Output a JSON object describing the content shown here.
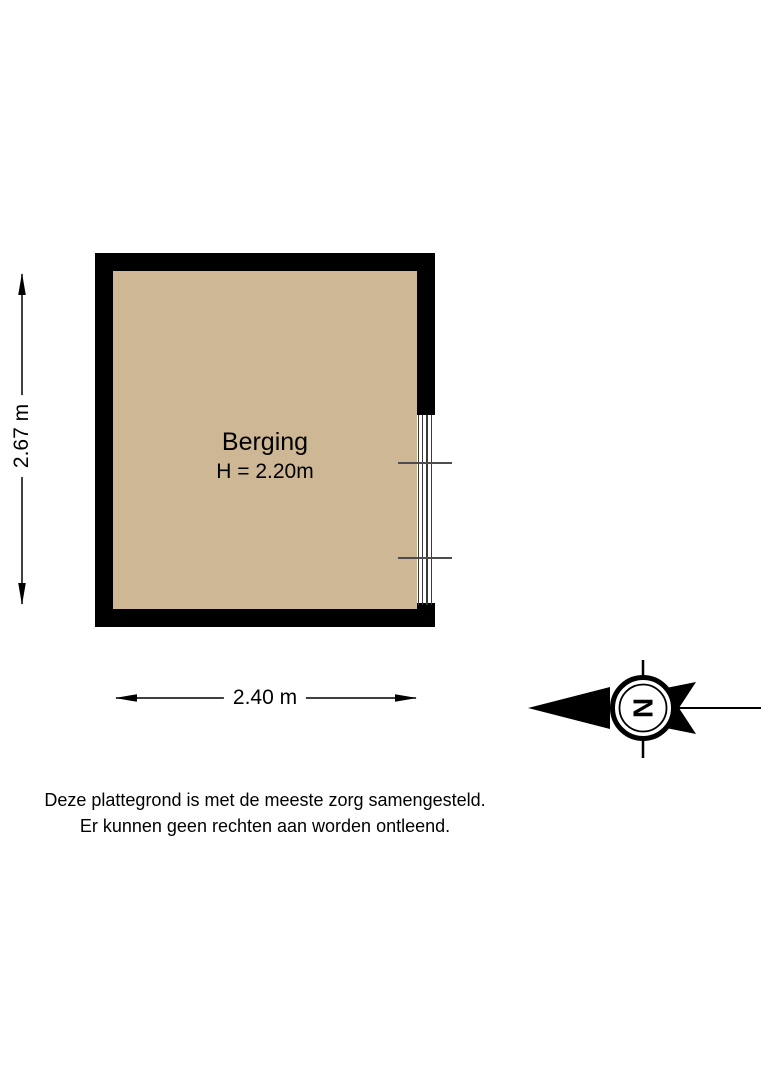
{
  "room": {
    "name": "Berging",
    "ceiling_height": "H = 2.20m"
  },
  "dimensions": {
    "width": "2.40 m",
    "depth": "2.67 m"
  },
  "compass": {
    "north_letter": "N"
  },
  "disclaimer": {
    "line1": "Deze plattegrond is met de meeste zorg samengesteld.",
    "line2": "Er kunnen geen rechten aan worden ontleend."
  },
  "colors": {
    "floor": "#CEB795",
    "wall": "#000000",
    "text": "#000000"
  }
}
